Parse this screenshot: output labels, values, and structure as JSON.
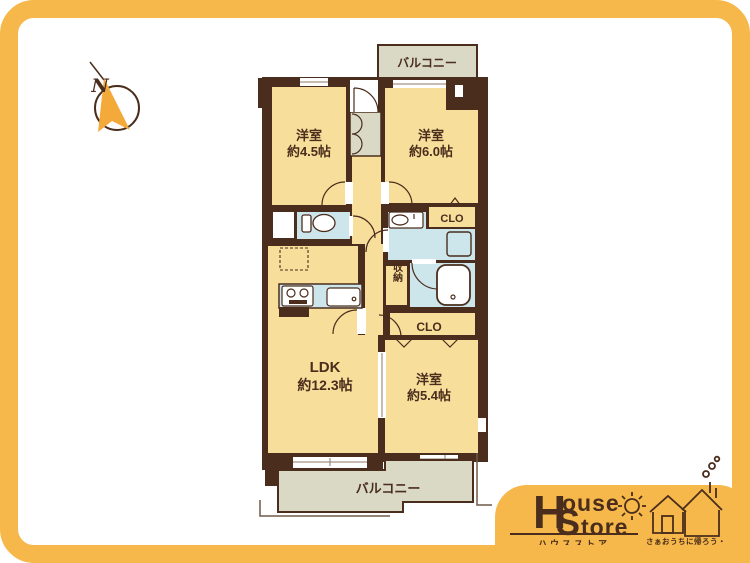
{
  "compass": {
    "n_label": "N"
  },
  "floorplan": {
    "balcony_top_label": "バルコニー",
    "balcony_bottom_label": "バルコニー",
    "room_west_small": {
      "name": "洋室",
      "size": "約4.5帖"
    },
    "room_west_large": {
      "name": "洋室",
      "size": "約6.0帖"
    },
    "room_west_mid": {
      "name": "洋室",
      "size": "約5.4帖"
    },
    "ldk": {
      "name": "LDK",
      "size": "約12.3帖"
    },
    "closet_upper_label": "CLO",
    "closet_lower_label": "CLO",
    "storage_label": "収納"
  },
  "logo": {
    "word1_initial": "H",
    "word1_rest": "ouse",
    "word2_initial": "S",
    "word2_rest": "tore",
    "katakana": "ハウスストア",
    "slogan": "さぁおうちに帰ろう・・・"
  },
  "colors": {
    "frame_yellow": "#f6b84a",
    "wall_brown": "#4a2d1c",
    "room_fill": "#f8de9b",
    "wet_area_fill": "#cde6ec",
    "balcony_fill": "#d9d9c6",
    "arrow_yellow": "#f3aa3b"
  }
}
